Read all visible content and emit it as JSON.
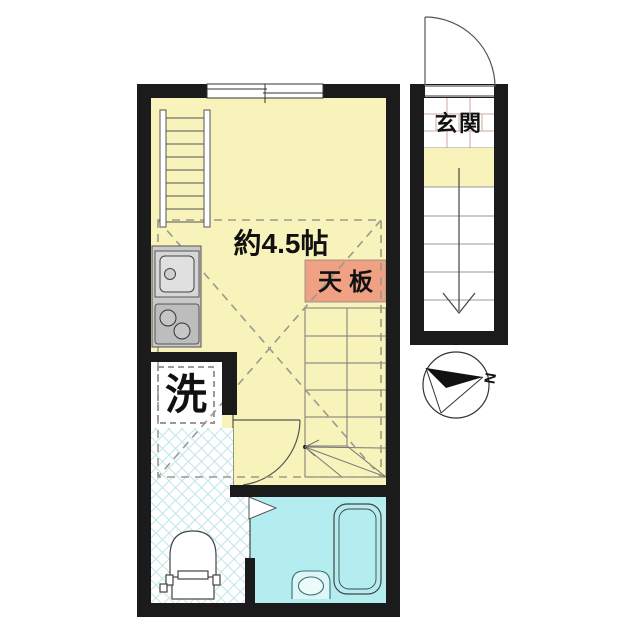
{
  "labels": {
    "room_size": "約4.5帖",
    "counter_top": "天板",
    "washing_machine": "洗",
    "entrance": "玄関",
    "compass_north": "N"
  },
  "colors": {
    "wall": "#1b1b1b",
    "room_yellow": "#f8f3ba",
    "counter_top_orange": "#f0a183",
    "bath_cyan": "#b4edef",
    "lattice_line": "#c2e6e6",
    "kitchen_gray": "#c9c9c9",
    "tile_line": "#cfaaa2"
  },
  "icons": {
    "loft_ladder": "ladder",
    "kitchen_sink": "sink",
    "gas_stove": "two-burner-stove",
    "interior_staircase": "staircase-with-winders",
    "entrance_staircase": "staircase-down-arrow",
    "entrance_door": "door-swing-arc",
    "room_door": "door-swing-arc",
    "bathroom_door": "folding-door-triangle",
    "toilet": "toilet",
    "bathtub": "bathtub",
    "washbasin": "washbasin",
    "compass": "north-arrow"
  }
}
